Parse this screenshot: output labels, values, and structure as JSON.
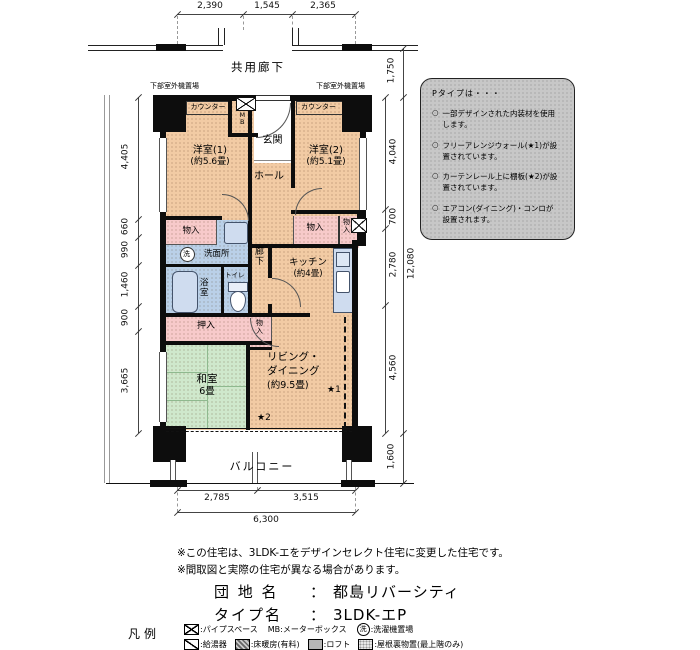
{
  "plan": {
    "kyoyo_roka": "共用廊下",
    "outdoor_left": "下部室外機置場",
    "outdoor_right": "下部室外機置場",
    "counter_left": "カウンター",
    "counter_right": "カウンター",
    "mb": "MB",
    "genkan": "玄関",
    "hall": "ホール",
    "yoshitsu1_name": "洋室(1)",
    "yoshitsu1_size": "(約5.6畳)",
    "yoshitsu2_name": "洋室(2)",
    "yoshitsu2_size": "(約5.1畳)",
    "monoire_left": "物入",
    "monoire_right": "物入",
    "monoire_right2": "物入",
    "monoire_small": "物入",
    "senmenjo": "洗面所",
    "wash_mark": "洗",
    "yokushitsu": "浴室",
    "toilet": "トイレ",
    "roka": "廊下",
    "kitchen_name": "キッチン",
    "kitchen_size": "(約4畳)",
    "oshiire": "押入",
    "washitsu_name": "和室",
    "washitsu_size": "6畳",
    "living_name1": "リビング・",
    "living_name2": "ダイニング",
    "living_size": "(約9.5畳)",
    "star1": "★1",
    "star2": "★2",
    "balcony": "バルコニー"
  },
  "dims": {
    "top": [
      "2,390",
      "1,545",
      "2,365"
    ],
    "left": [
      "4,405",
      "660",
      "990",
      "1,460",
      "900",
      "3,665"
    ],
    "right_top": "1,750",
    "right_inner": [
      "4,040",
      "700",
      "2,780",
      "4,560"
    ],
    "right_total": "12,080",
    "right_bottom": "1,600",
    "bottom": [
      "2,785",
      "3,515"
    ],
    "bottom_total": "6,300"
  },
  "info_box": {
    "title": "Pタイプは・・・",
    "bullet": "○",
    "items": [
      "一部デザインされた内装材を使用します。",
      "フリーアレンジウォール(★1)が設置されています。",
      "カーテンレール上に棚板(★2)が設置されています。",
      "エアコン(ダイニング)・コンロが設置されます。"
    ]
  },
  "notes": [
    "※この住宅は、3LDK-エをデザインセレクト住宅に変更した住宅です。",
    "※間取図と実際の住宅が異なる場合があります。"
  ],
  "danchi": {
    "label": "団 地 名",
    "colon": "：",
    "value": "都島リバーシティ"
  },
  "type_name": {
    "label": "タイプ名",
    "colon": "：",
    "value": "3LDK-エP"
  },
  "legend": {
    "title": "凡例",
    "pipe_space": ":パイプスペース",
    "mb": "MB:メーターボックス",
    "washer": ":洗濯機置場",
    "wash_char": "洗",
    "heater": ":給湯器",
    "floor_heating": ":床暖房(有料)",
    "loft": ":ロフト",
    "attic": ":屋根裏物置(最上階のみ)"
  },
  "colors": {
    "room_peach": "#f2cba4",
    "tatami_green": "#cfe8cc",
    "wet_blue": "#bad0e8",
    "storage_pink": "#f7caca",
    "note_box_gray": "#c7c7c7",
    "wall_black": "#0d0d0d"
  }
}
